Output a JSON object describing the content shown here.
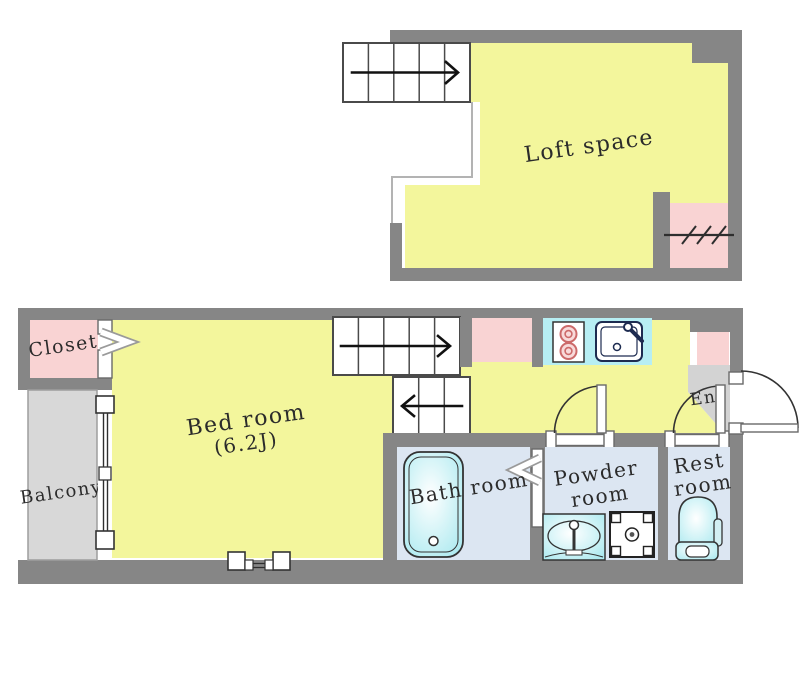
{
  "title": "Apartment floor plan with loft",
  "labels": {
    "loft": "Loft space",
    "bedroom": "Bed room",
    "bedroom_size": "(6.2J)",
    "closet": "Closet",
    "balcony": "Balcony",
    "bath": "Bath room",
    "powder_line1": "Powder",
    "powder_line2": "room",
    "rest_line1": "Rest",
    "rest_line2": "room",
    "entrance": "Ent"
  },
  "colors": {
    "wall": "#868686",
    "floor_yellow": "#f3f69c",
    "room_pink": "#f9d3d3",
    "fixture_cyan": "#aeeaf0",
    "counter_cyan": "#b7eef3",
    "wet_floor_blue": "#dce6f2",
    "balcony_gray": "#d8d8d8",
    "entrance_gray": "#d3d3d3",
    "outline": "#333333"
  }
}
